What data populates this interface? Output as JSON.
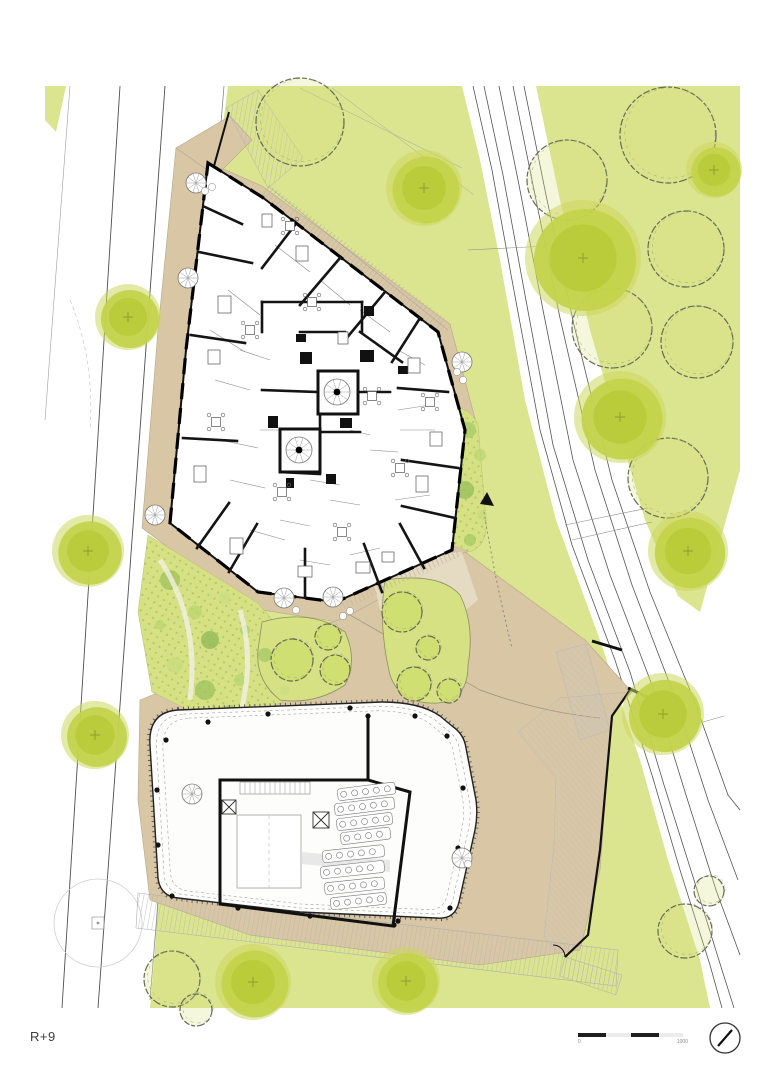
{
  "drawing": {
    "level_label": "R+9",
    "scale": {
      "zero": "0",
      "max": "1000"
    }
  },
  "palette": {
    "green_field": "#dbe48e",
    "green_bright": "#d6e183",
    "tan": "#d8c6a4",
    "tan_light": "#e8dec9",
    "tree_solid": "#c3d24a",
    "tree_core": "#b7ca37",
    "sketch_stroke": "#666b57",
    "wall": "#141414",
    "hatch": "#bcbcbc",
    "road_line": "#4f4f4f"
  },
  "site": {
    "solid_trees": [
      {
        "x": 424,
        "y": 188,
        "r": 38
      },
      {
        "x": 128,
        "y": 317,
        "r": 33
      },
      {
        "x": 583,
        "y": 258,
        "r": 58
      },
      {
        "x": 714,
        "y": 170,
        "r": 28
      },
      {
        "x": 620,
        "y": 417,
        "r": 46
      },
      {
        "x": 688,
        "y": 551,
        "r": 40
      },
      {
        "x": 663,
        "y": 714,
        "r": 41
      },
      {
        "x": 88,
        "y": 551,
        "r": 36
      },
      {
        "x": 95,
        "y": 735,
        "r": 34
      },
      {
        "x": 253,
        "y": 982,
        "r": 38
      },
      {
        "x": 406,
        "y": 981,
        "r": 34
      }
    ],
    "sketch_trees": [
      {
        "x": 300,
        "y": 122,
        "r": 44
      },
      {
        "x": 567,
        "y": 180,
        "r": 40
      },
      {
        "x": 668,
        "y": 135,
        "r": 48
      },
      {
        "x": 686,
        "y": 249,
        "r": 38
      },
      {
        "x": 612,
        "y": 328,
        "r": 40
      },
      {
        "x": 697,
        "y": 342,
        "r": 36
      },
      {
        "x": 668,
        "y": 478,
        "r": 40
      },
      {
        "x": 172,
        "y": 979,
        "r": 28
      },
      {
        "x": 196,
        "y": 1010,
        "r": 16
      },
      {
        "x": 685,
        "y": 931,
        "r": 27
      },
      {
        "x": 709,
        "y": 891,
        "r": 15
      }
    ],
    "island_trees": [
      {
        "x": 292,
        "y": 660,
        "r": 21
      },
      {
        "x": 328,
        "y": 637,
        "r": 13
      },
      {
        "x": 335,
        "y": 670,
        "r": 15
      },
      {
        "x": 402,
        "y": 612,
        "r": 20
      },
      {
        "x": 428,
        "y": 648,
        "r": 12
      },
      {
        "x": 414,
        "y": 684,
        "r": 17
      },
      {
        "x": 449,
        "y": 691,
        "r": 12
      }
    ],
    "shrubs": [
      [
        170,
        580,
        10,
        "#9fc25c"
      ],
      [
        195,
        612,
        7,
        "#b8d56e"
      ],
      [
        225,
        598,
        6,
        "#cade84"
      ],
      [
        210,
        640,
        9,
        "#8fb754"
      ],
      [
        245,
        630,
        5,
        "#a9cd68"
      ],
      [
        175,
        665,
        8,
        "#c6dc7f"
      ],
      [
        205,
        690,
        10,
        "#9cc25f"
      ],
      [
        240,
        680,
        6,
        "#b5d471"
      ],
      [
        265,
        655,
        7,
        "#a3c763"
      ],
      [
        285,
        690,
        5,
        "#cade84"
      ],
      [
        160,
        625,
        5,
        "#b8d56e"
      ],
      [
        230,
        712,
        7,
        "#9fc25c"
      ],
      [
        468,
        430,
        8,
        "#a6ca64"
      ],
      [
        480,
        455,
        6,
        "#bcd773"
      ],
      [
        465,
        490,
        9,
        "#96bd58"
      ],
      [
        482,
        515,
        5,
        "#c6dc7f"
      ],
      [
        470,
        540,
        6,
        "#a6ca64"
      ]
    ],
    "upper": {
      "walls": [
        [
          295,
          225,
          262,
          268
        ],
        [
          340,
          258,
          300,
          305
        ],
        [
          385,
          292,
          345,
          340
        ],
        [
          420,
          318,
          392,
          362
        ],
        [
          448,
          392,
          398,
          388
        ],
        [
          458,
          468,
          402,
          460
        ],
        [
          455,
          518,
          402,
          506
        ],
        [
          424,
          568,
          400,
          524
        ],
        [
          382,
          592,
          364,
          544
        ],
        [
          305,
          597,
          305,
          549
        ],
        [
          229,
          572,
          257,
          524
        ],
        [
          197,
          548,
          229,
          503
        ],
        [
          183,
          438,
          237,
          441
        ],
        [
          191,
          335,
          245,
          343
        ],
        [
          199,
          252,
          252,
          263
        ],
        [
          205,
          207,
          242,
          224
        ],
        [
          262,
          302,
          362,
          302
        ],
        [
          362,
          302,
          362,
          332
        ],
        [
          262,
          302,
          262,
          332
        ],
        [
          300,
          332,
          345,
          332
        ],
        [
          360,
          332,
          402,
          362
        ],
        [
          262,
          390,
          318,
          392
        ],
        [
          358,
          392,
          390,
          392
        ],
        [
          320,
          414,
          320,
          432
        ],
        [
          280,
          472,
          320,
          474
        ],
        [
          320,
          432,
          360,
          432
        ]
      ],
      "thin": [
        [
          275,
          245,
          310,
          272
        ],
        [
          320,
          280,
          350,
          305
        ],
        [
          360,
          310,
          390,
          332
        ],
        [
          228,
          290,
          260,
          315
        ],
        [
          210,
          330,
          245,
          352
        ],
        [
          215,
          380,
          250,
          390
        ],
        [
          220,
          440,
          258,
          448
        ],
        [
          230,
          480,
          265,
          488
        ],
        [
          250,
          530,
          285,
          540
        ],
        [
          300,
          560,
          330,
          565
        ],
        [
          350,
          555,
          380,
          548
        ],
        [
          395,
          500,
          430,
          495
        ],
        [
          400,
          430,
          435,
          430
        ],
        [
          398,
          410,
          430,
          405
        ],
        [
          370,
          450,
          398,
          452
        ],
        [
          330,
          500,
          360,
          505
        ],
        [
          280,
          520,
          310,
          526
        ],
        [
          240,
          350,
          270,
          360
        ],
        [
          398,
          350,
          425,
          365
        ],
        [
          260,
          430,
          280,
          430
        ],
        [
          350,
          430,
          370,
          435
        ],
        [
          310,
          480,
          340,
          485
        ]
      ],
      "shafts": [
        [
          360,
          350,
          14,
          12
        ],
        [
          300,
          352,
          12,
          12
        ],
        [
          268,
          416,
          10,
          12
        ],
        [
          340,
          418,
          12,
          10
        ],
        [
          296,
          334,
          10,
          8
        ],
        [
          364,
          306,
          10,
          10
        ],
        [
          326,
          474,
          10,
          10
        ],
        [
          286,
          478,
          8,
          10
        ],
        [
          398,
          366,
          10,
          8
        ]
      ],
      "cores": [
        {
          "x": 318,
          "y": 371,
          "w": 40,
          "h": 43,
          "sx": 337,
          "sy": 392
        },
        {
          "x": 280,
          "y": 429,
          "w": 40,
          "h": 43,
          "sx": 299,
          "sy": 450
        }
      ],
      "furn_rect": [
        [
          218,
          296,
          13,
          17
        ],
        [
          194,
          466,
          12,
          16
        ],
        [
          230,
          538,
          13,
          16
        ],
        [
          298,
          566,
          14,
          11
        ],
        [
          356,
          562,
          14,
          11
        ],
        [
          416,
          476,
          12,
          16
        ],
        [
          408,
          358,
          12,
          15
        ],
        [
          296,
          246,
          12,
          15
        ],
        [
          262,
          214,
          10,
          13
        ],
        [
          430,
          432,
          12,
          14
        ],
        [
          208,
          350,
          12,
          14
        ],
        [
          382,
          552,
          12,
          10
        ],
        [
          338,
          332,
          10,
          12
        ]
      ],
      "furn_table": [
        [
          250,
          330
        ],
        [
          216,
          422
        ],
        [
          282,
          492
        ],
        [
          342,
          532
        ],
        [
          400,
          468
        ],
        [
          372,
          396
        ],
        [
          312,
          302
        ],
        [
          290,
          226
        ],
        [
          430,
          402
        ]
      ]
    },
    "outdoor_spirals": [
      [
        196,
        183
      ],
      [
        188,
        278
      ],
      [
        155,
        515
      ],
      [
        284,
        598
      ],
      [
        333,
        597
      ],
      [
        462,
        362
      ],
      [
        192,
        794
      ],
      [
        462,
        858
      ]
    ],
    "terrace_circles": [
      [
        205,
        191
      ],
      [
        212,
        187
      ],
      [
        296,
        610
      ],
      [
        343,
        616
      ],
      [
        350,
        611
      ],
      [
        457,
        372
      ],
      [
        463,
        380
      ],
      [
        198,
        792
      ],
      [
        468,
        864
      ]
    ],
    "lower": {
      "columns": [
        [
          208,
          722
        ],
        [
          268,
          714
        ],
        [
          350,
          708
        ],
        [
          415,
          716
        ],
        [
          447,
          736
        ],
        [
          463,
          788
        ],
        [
          458,
          848
        ],
        [
          450,
          908
        ],
        [
          398,
          921
        ],
        [
          310,
          916
        ],
        [
          238,
          908
        ],
        [
          172,
          896
        ],
        [
          158,
          845
        ],
        [
          157,
          790
        ],
        [
          166,
          740
        ],
        [
          368,
          716
        ],
        [
          394,
          925
        ]
      ],
      "table_rows": [
        [
          337,
          789,
          58,
          -7
        ],
        [
          334,
          804,
          60,
          -7
        ],
        [
          336,
          819,
          56,
          -7
        ],
        [
          340,
          833,
          50,
          -7
        ],
        [
          322,
          851,
          62,
          -6
        ],
        [
          320,
          867,
          64,
          -6
        ],
        [
          324,
          883,
          60,
          -6
        ],
        [
          330,
          898,
          56,
          -6
        ]
      ]
    },
    "road_bars": [
      [
        592,
        641,
        622,
        650
      ],
      [
        628,
        688,
        654,
        700
      ]
    ]
  }
}
